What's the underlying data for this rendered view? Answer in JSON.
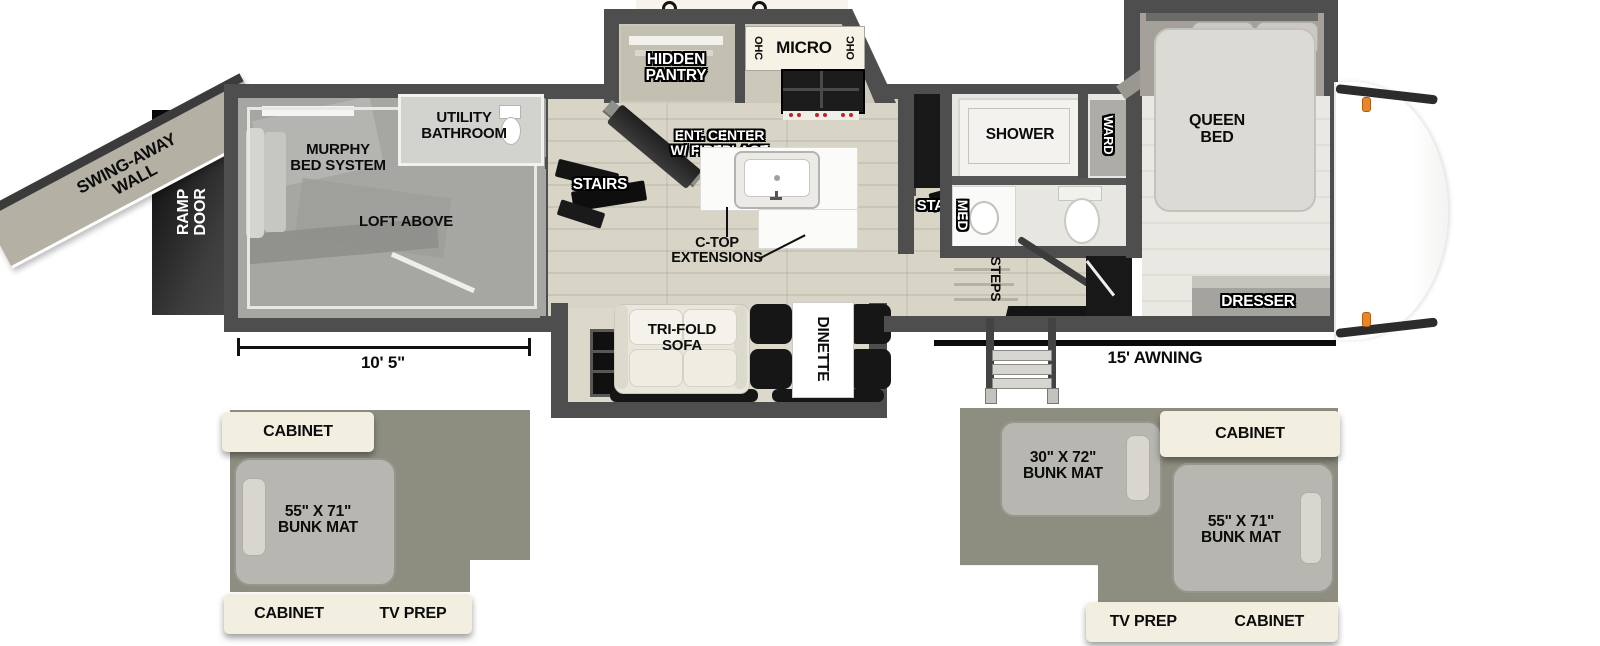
{
  "exterior": {
    "swing_away_wall": "SWING-AWAY\nWALL",
    "ramp_door": "RAMP\nDOOR",
    "awning": "15' AWNING",
    "garage_dimension": "10' 5\""
  },
  "garage": {
    "murphy_bed": "MURPHY\nBED SYSTEM",
    "loft_above": "LOFT ABOVE",
    "utility_bathroom": "UTILITY\nBATHROOM",
    "cabinet": "CABINET",
    "stairs": "STAIRS"
  },
  "kitchen": {
    "hidden_pantry": "HIDDEN\nPANTRY",
    "ohc_left": "OHC",
    "micro": "MICRO",
    "ohc_right": "OHC",
    "ent_center": "ENT. CENTER\nW/ FIREPLACE",
    "ctop_extensions": "C-TOP\nEXTENSIONS",
    "fridge": "FRIDGE",
    "stairs": "STAIRS"
  },
  "living": {
    "tri_fold_sofa": "TRI-FOLD\nSOFA",
    "dinette": "DINETTE"
  },
  "bathroom": {
    "shower": "SHOWER",
    "med": "MED",
    "ward": "WARD"
  },
  "bedroom": {
    "queen_bed": "QUEEN\nBED",
    "dresser": "DRESSER",
    "steps": "STEPS"
  },
  "loft_left": {
    "cabinet_top": "CABINET",
    "bunk_mat": "55\" X 71\"\nBUNK MAT",
    "cabinet_bottom": "CABINET",
    "tv_prep": "TV PREP"
  },
  "loft_right": {
    "bunk_mat_small": "30\" X 72\"\nBUNK MAT",
    "cabinet_top": "CABINET",
    "bunk_mat_large": "55\" X 71\"\nBUNK MAT",
    "tv_prep": "TV PREP",
    "cabinet_bottom": "CABINET"
  },
  "colors": {
    "wall": "#4e4e4e",
    "garage_floor": "#a6a6a2",
    "kitchen_floor": "#d7d3c5",
    "bedroom_floor": "#eae8e3",
    "loft_base_gray": "#8e8e80",
    "cabinet_cream": "#f2efe0",
    "bunk_mat_gray": "#b7b6b0",
    "marker_light_orange": "#e8862a",
    "stairs_black": "#141414"
  }
}
